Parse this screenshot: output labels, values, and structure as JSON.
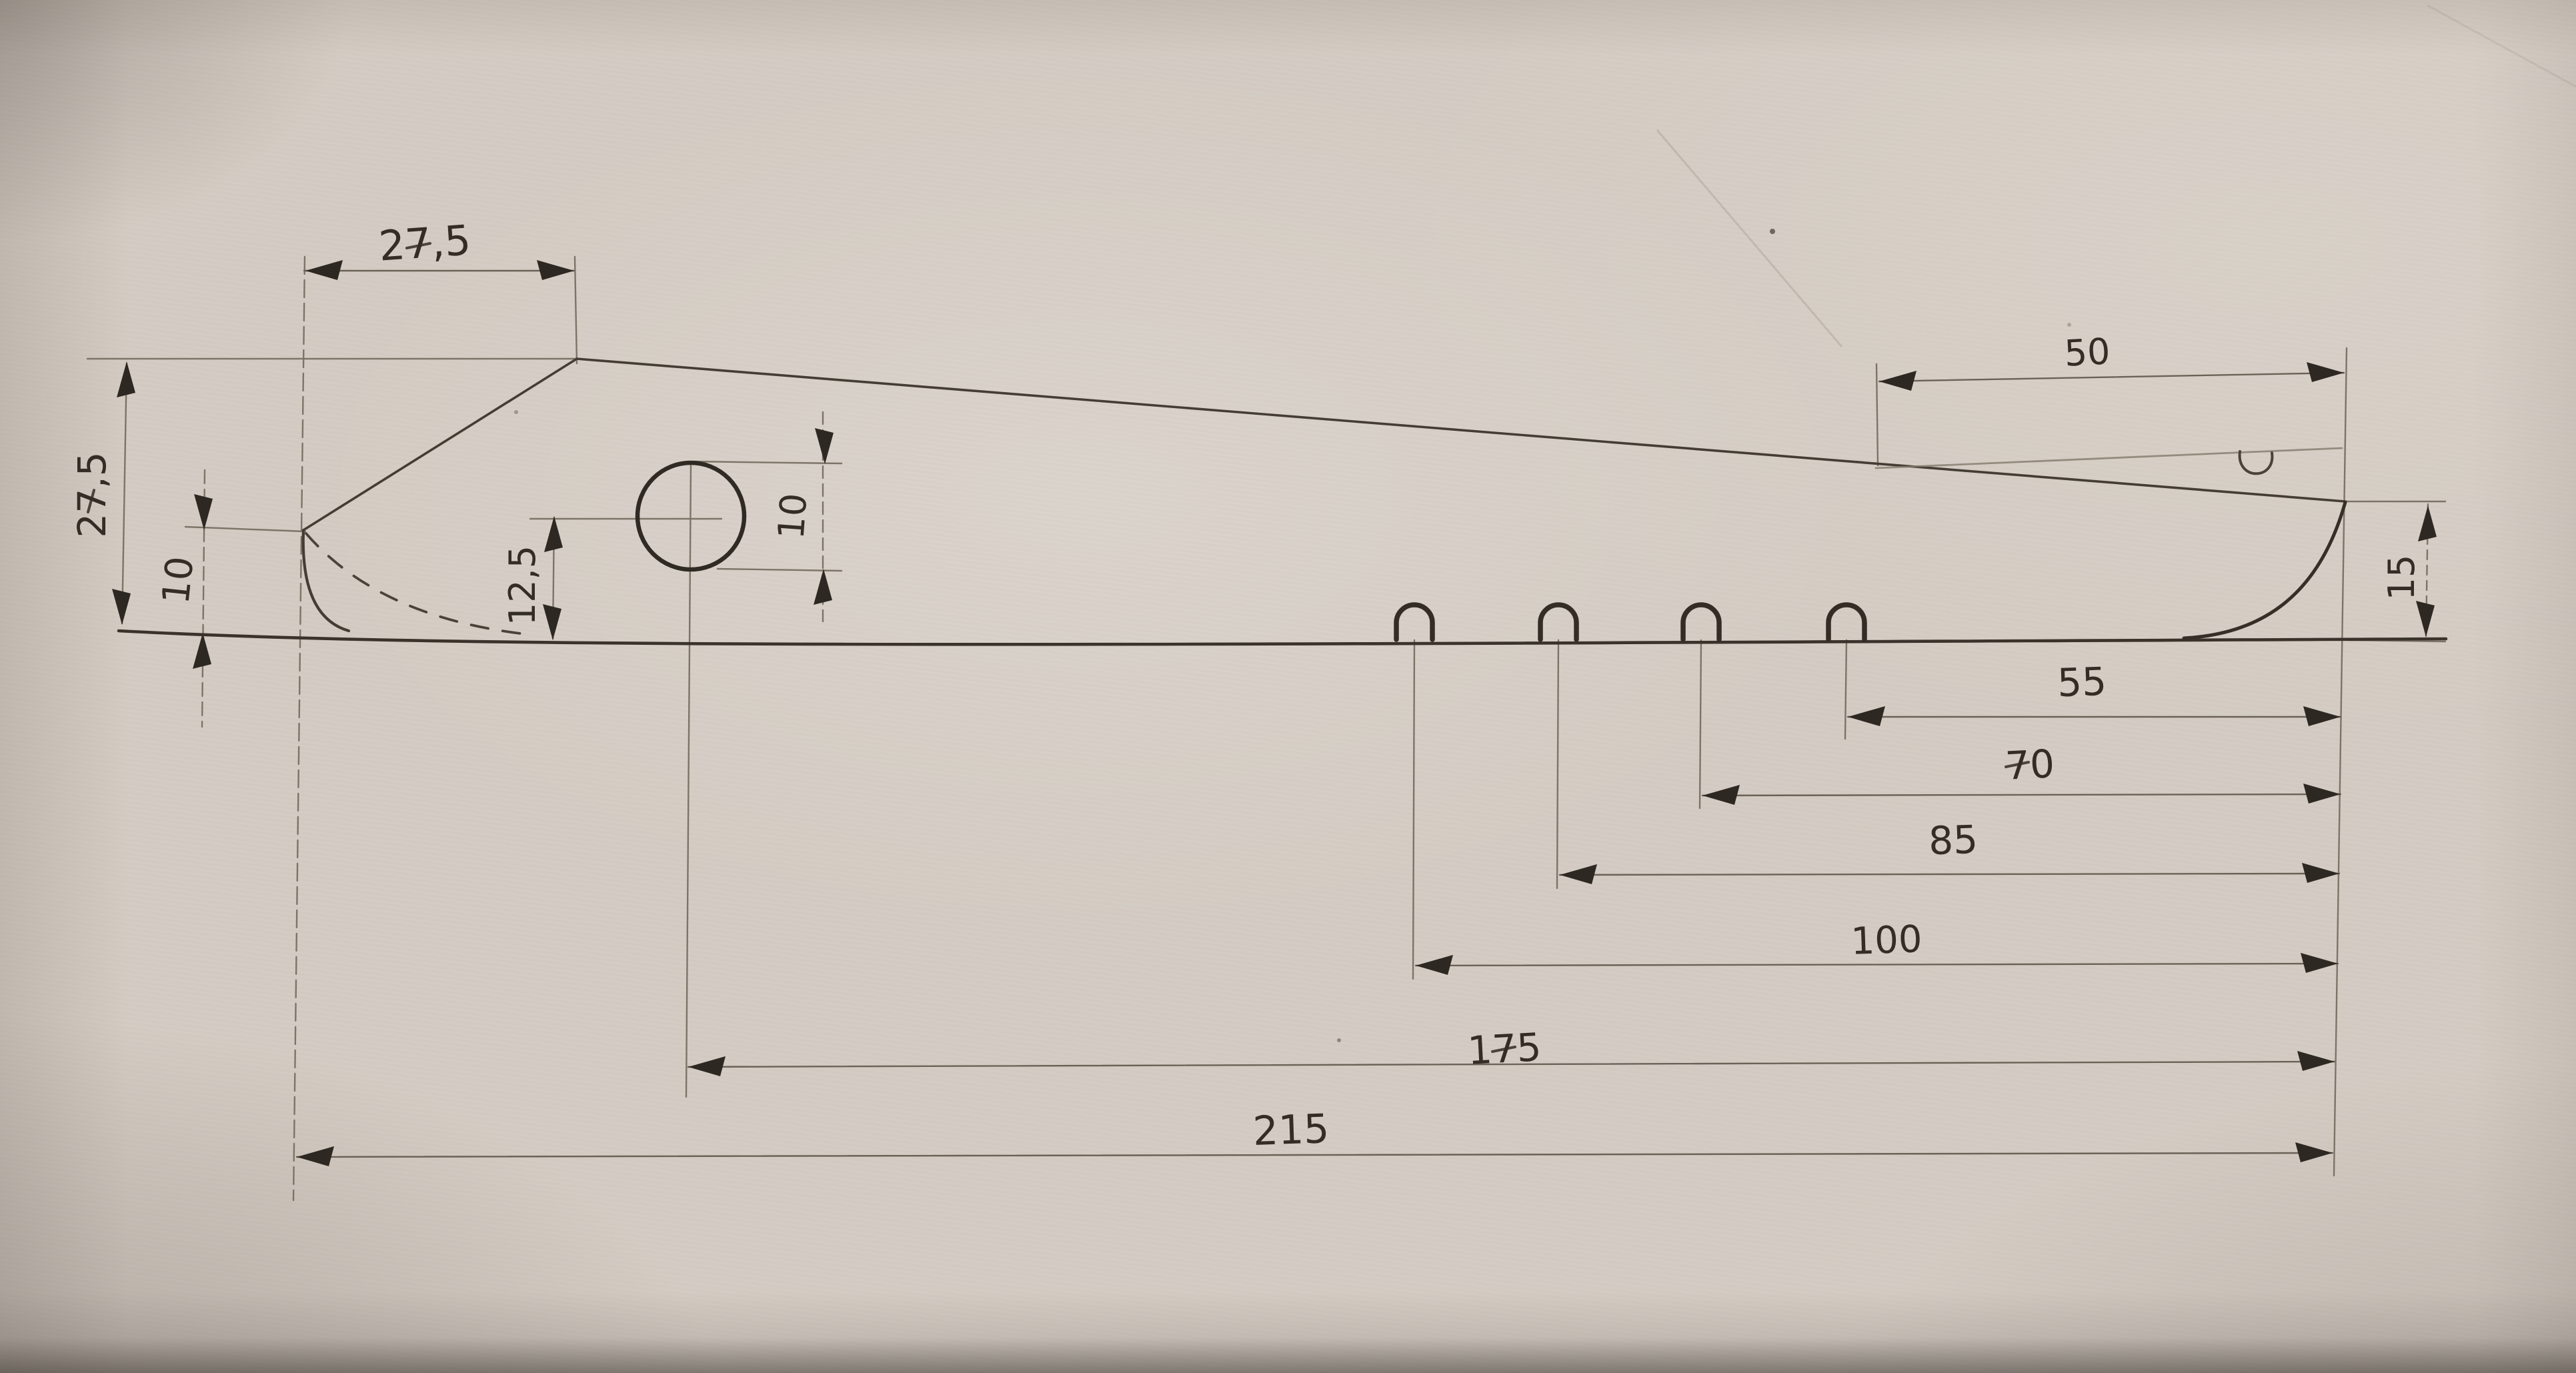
{
  "drawing_title": "",
  "colors": {
    "paper": "#d4ccc3",
    "pencil": "#4a433a",
    "pencil_dark": "#2d2822",
    "pencil_faint": "#8a8176"
  },
  "dimensions": {
    "top_width": {
      "label": "27,5",
      "value": 27.5
    },
    "left_height": {
      "label": "27,5",
      "value": 27.5
    },
    "tip_height": {
      "label": "10",
      "value": 10
    },
    "hole_center_height": {
      "label": "12,5",
      "value": 12.5
    },
    "hole_diameter": {
      "label": "10",
      "value": 10
    },
    "right_top_length": {
      "label": "50",
      "value": 50
    },
    "right_end_height": {
      "label": "15",
      "value": 15
    },
    "slot_offsets_from_right": [
      {
        "label": "55",
        "value": 55
      },
      {
        "label": "70",
        "value": 70
      },
      {
        "label": "85",
        "value": 85
      },
      {
        "label": "100",
        "value": 100
      }
    ],
    "hole_center_from_right": {
      "label": "175",
      "value": 175
    },
    "overall_length": {
      "label": "215",
      "value": 215
    }
  },
  "features": {
    "slot_count": 4,
    "hole_count": 1,
    "notch_count": 1
  }
}
